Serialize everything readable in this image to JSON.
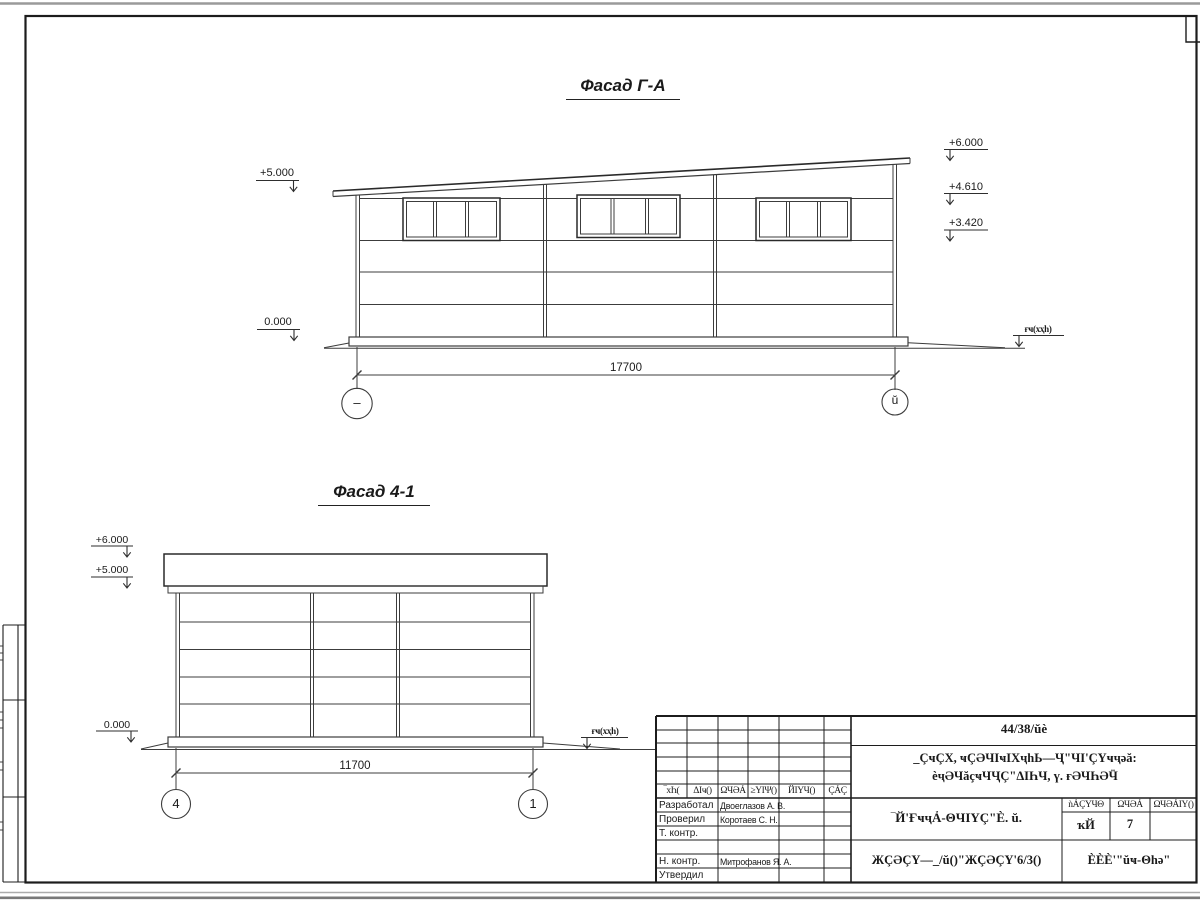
{
  "drawing": {
    "facade1": {
      "title": "Фасад Г-А",
      "dim": "17700",
      "axis_left": "–",
      "axis_right": "ŭ",
      "mark_plus5": "+5.000",
      "mark_zero": "0.000",
      "mark_plus6": "+6.000",
      "mark_4610": "+4.610",
      "mark_3420": "+3.420",
      "ground_label": "ғҹ(хҳһ)"
    },
    "facade2": {
      "title": "Фасад 4-1",
      "dim": "11700",
      "axis_left": "4",
      "axis_right": "1",
      "mark_plus6": "+6.000",
      "mark_plus5": "+5.000",
      "mark_zero": "0.000",
      "ground_label": "ғҹ(хҳһ)"
    }
  },
  "titleblock": {
    "doc_number": "44/38/ŭè",
    "project_line1": "_ÇҹÇХ, ҹÇӘЧӀҹӀХҷһЬ—Ҷ\"ЧӀ'ÇҮҹҷәă:",
    "project_line2": "ѐҷӘЧăҫҹЧҶÇ\"ΔӀҺЧ, ү. ғӘЧҺӘӴ",
    "rev_headers": [
      "‾хҺ(",
      "ΔӀҹ()",
      "ΩЧӘẢ",
      "≥ΥӀΨ()",
      "ЙӀҮЧ()",
      "ÇẢÇ"
    ],
    "roles": [
      {
        "label": "Разработал",
        "name": "Двоеглазов А. В."
      },
      {
        "label": "Проверил",
        "name": "Коротаев С. Н."
      },
      {
        "label": "Т. контр.",
        "name": ""
      },
      {
        "label": "",
        "name": ""
      },
      {
        "label": "Н. контр.",
        "name": "Митрофанов Я. А."
      },
      {
        "label": "Утвердил",
        "name": ""
      }
    ],
    "doc_title": "‾Й'ҒҹҷẢ-ΘЧӀΥÇ\"Ѐ. ŭ.",
    "stage_line": "ЖÇӘÇΥ—_/ŭ()\"ЖÇӘÇΥ'6/3()",
    "stadia_header": "ǹẢÇΥЧΘ",
    "list_header": "ΩЧӘẢ",
    "listov_header": "ΩЧӘẢӀΥ()",
    "stadia_value": "ҡЙ",
    "list_value": "7",
    "org": "ЀЀЀ'\"ŭҹ-Θһә\""
  }
}
